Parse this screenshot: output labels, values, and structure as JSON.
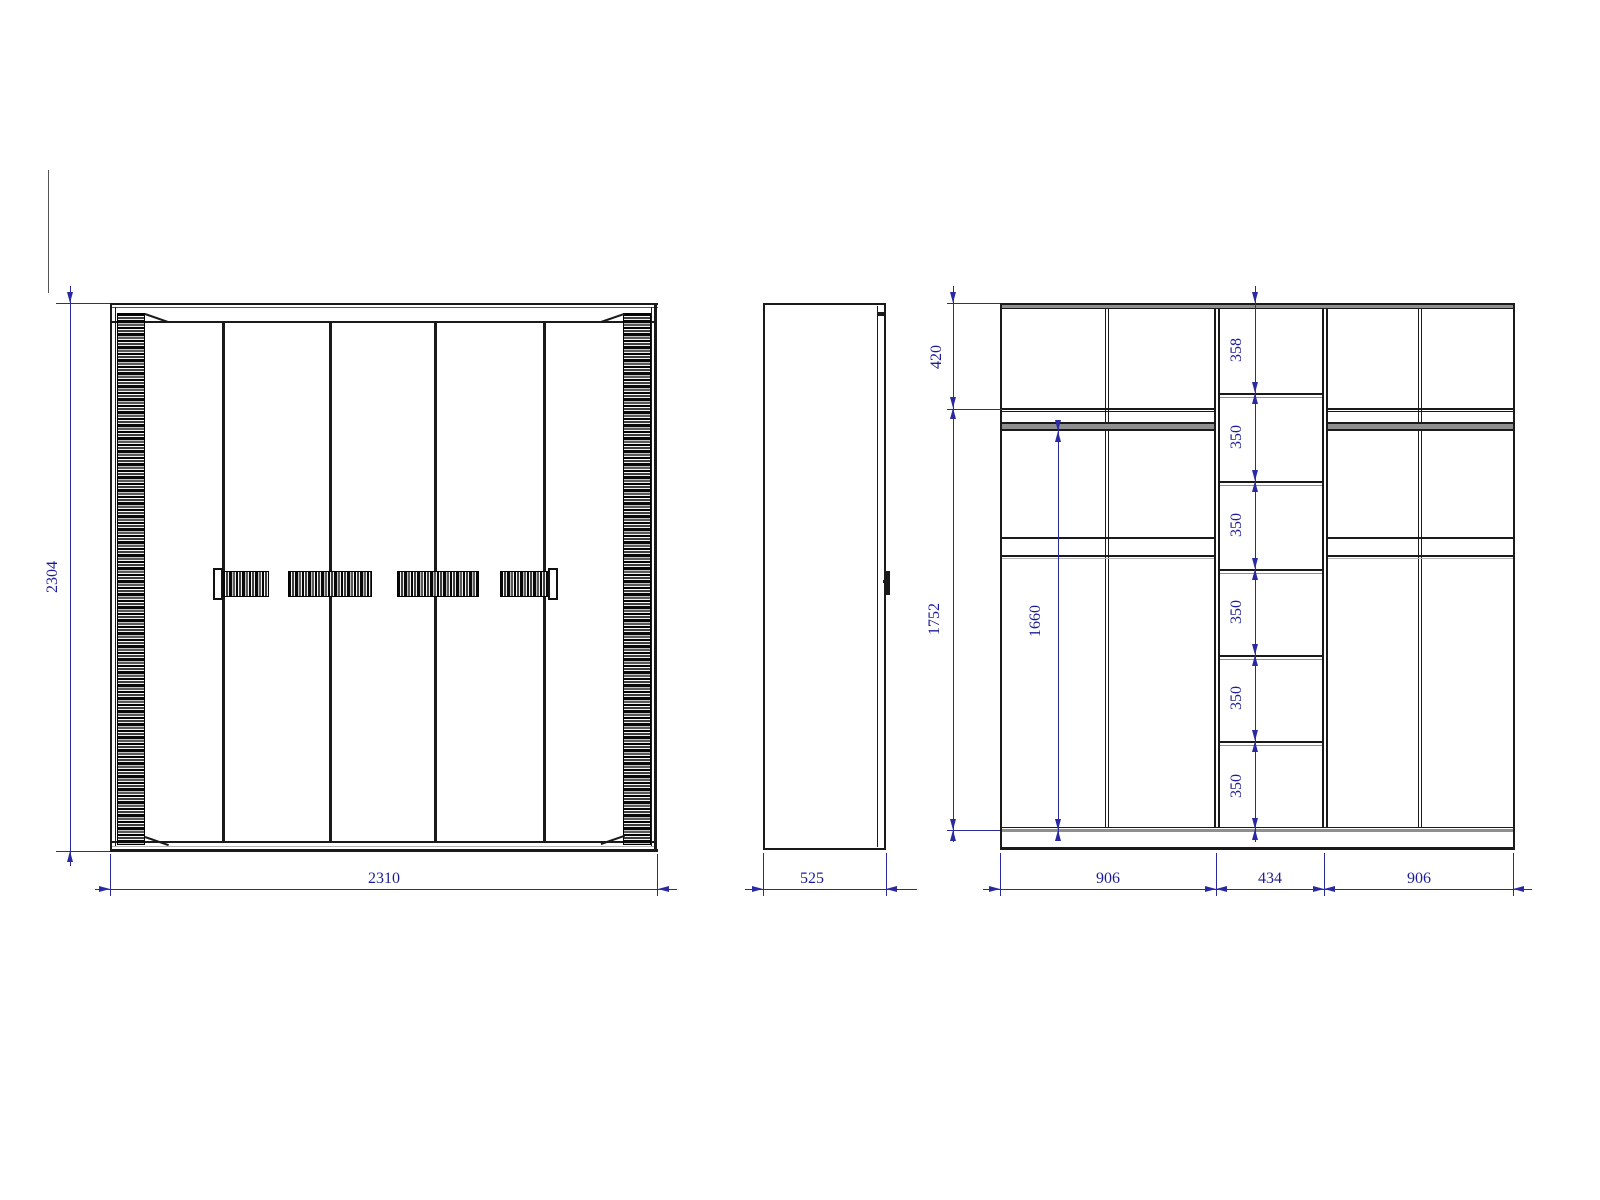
{
  "drawing": {
    "colors": {
      "line": "#1a1a1a",
      "dimension_line": "#2a2aa0",
      "dimension_text": "#1c1c96",
      "panel_gray": "#8f8f8f"
    },
    "front_view": {
      "height_label": "2304",
      "width_label": "2310"
    },
    "side_view": {
      "depth_label": "525"
    },
    "internal_view": {
      "top_section_label": "420",
      "interior_height_label": "1752",
      "hanging_height_label": "1660",
      "shelf_labels": [
        "358",
        "350",
        "350",
        "350",
        "350",
        "350"
      ],
      "width_labels": [
        "906",
        "434",
        "906"
      ]
    }
  }
}
